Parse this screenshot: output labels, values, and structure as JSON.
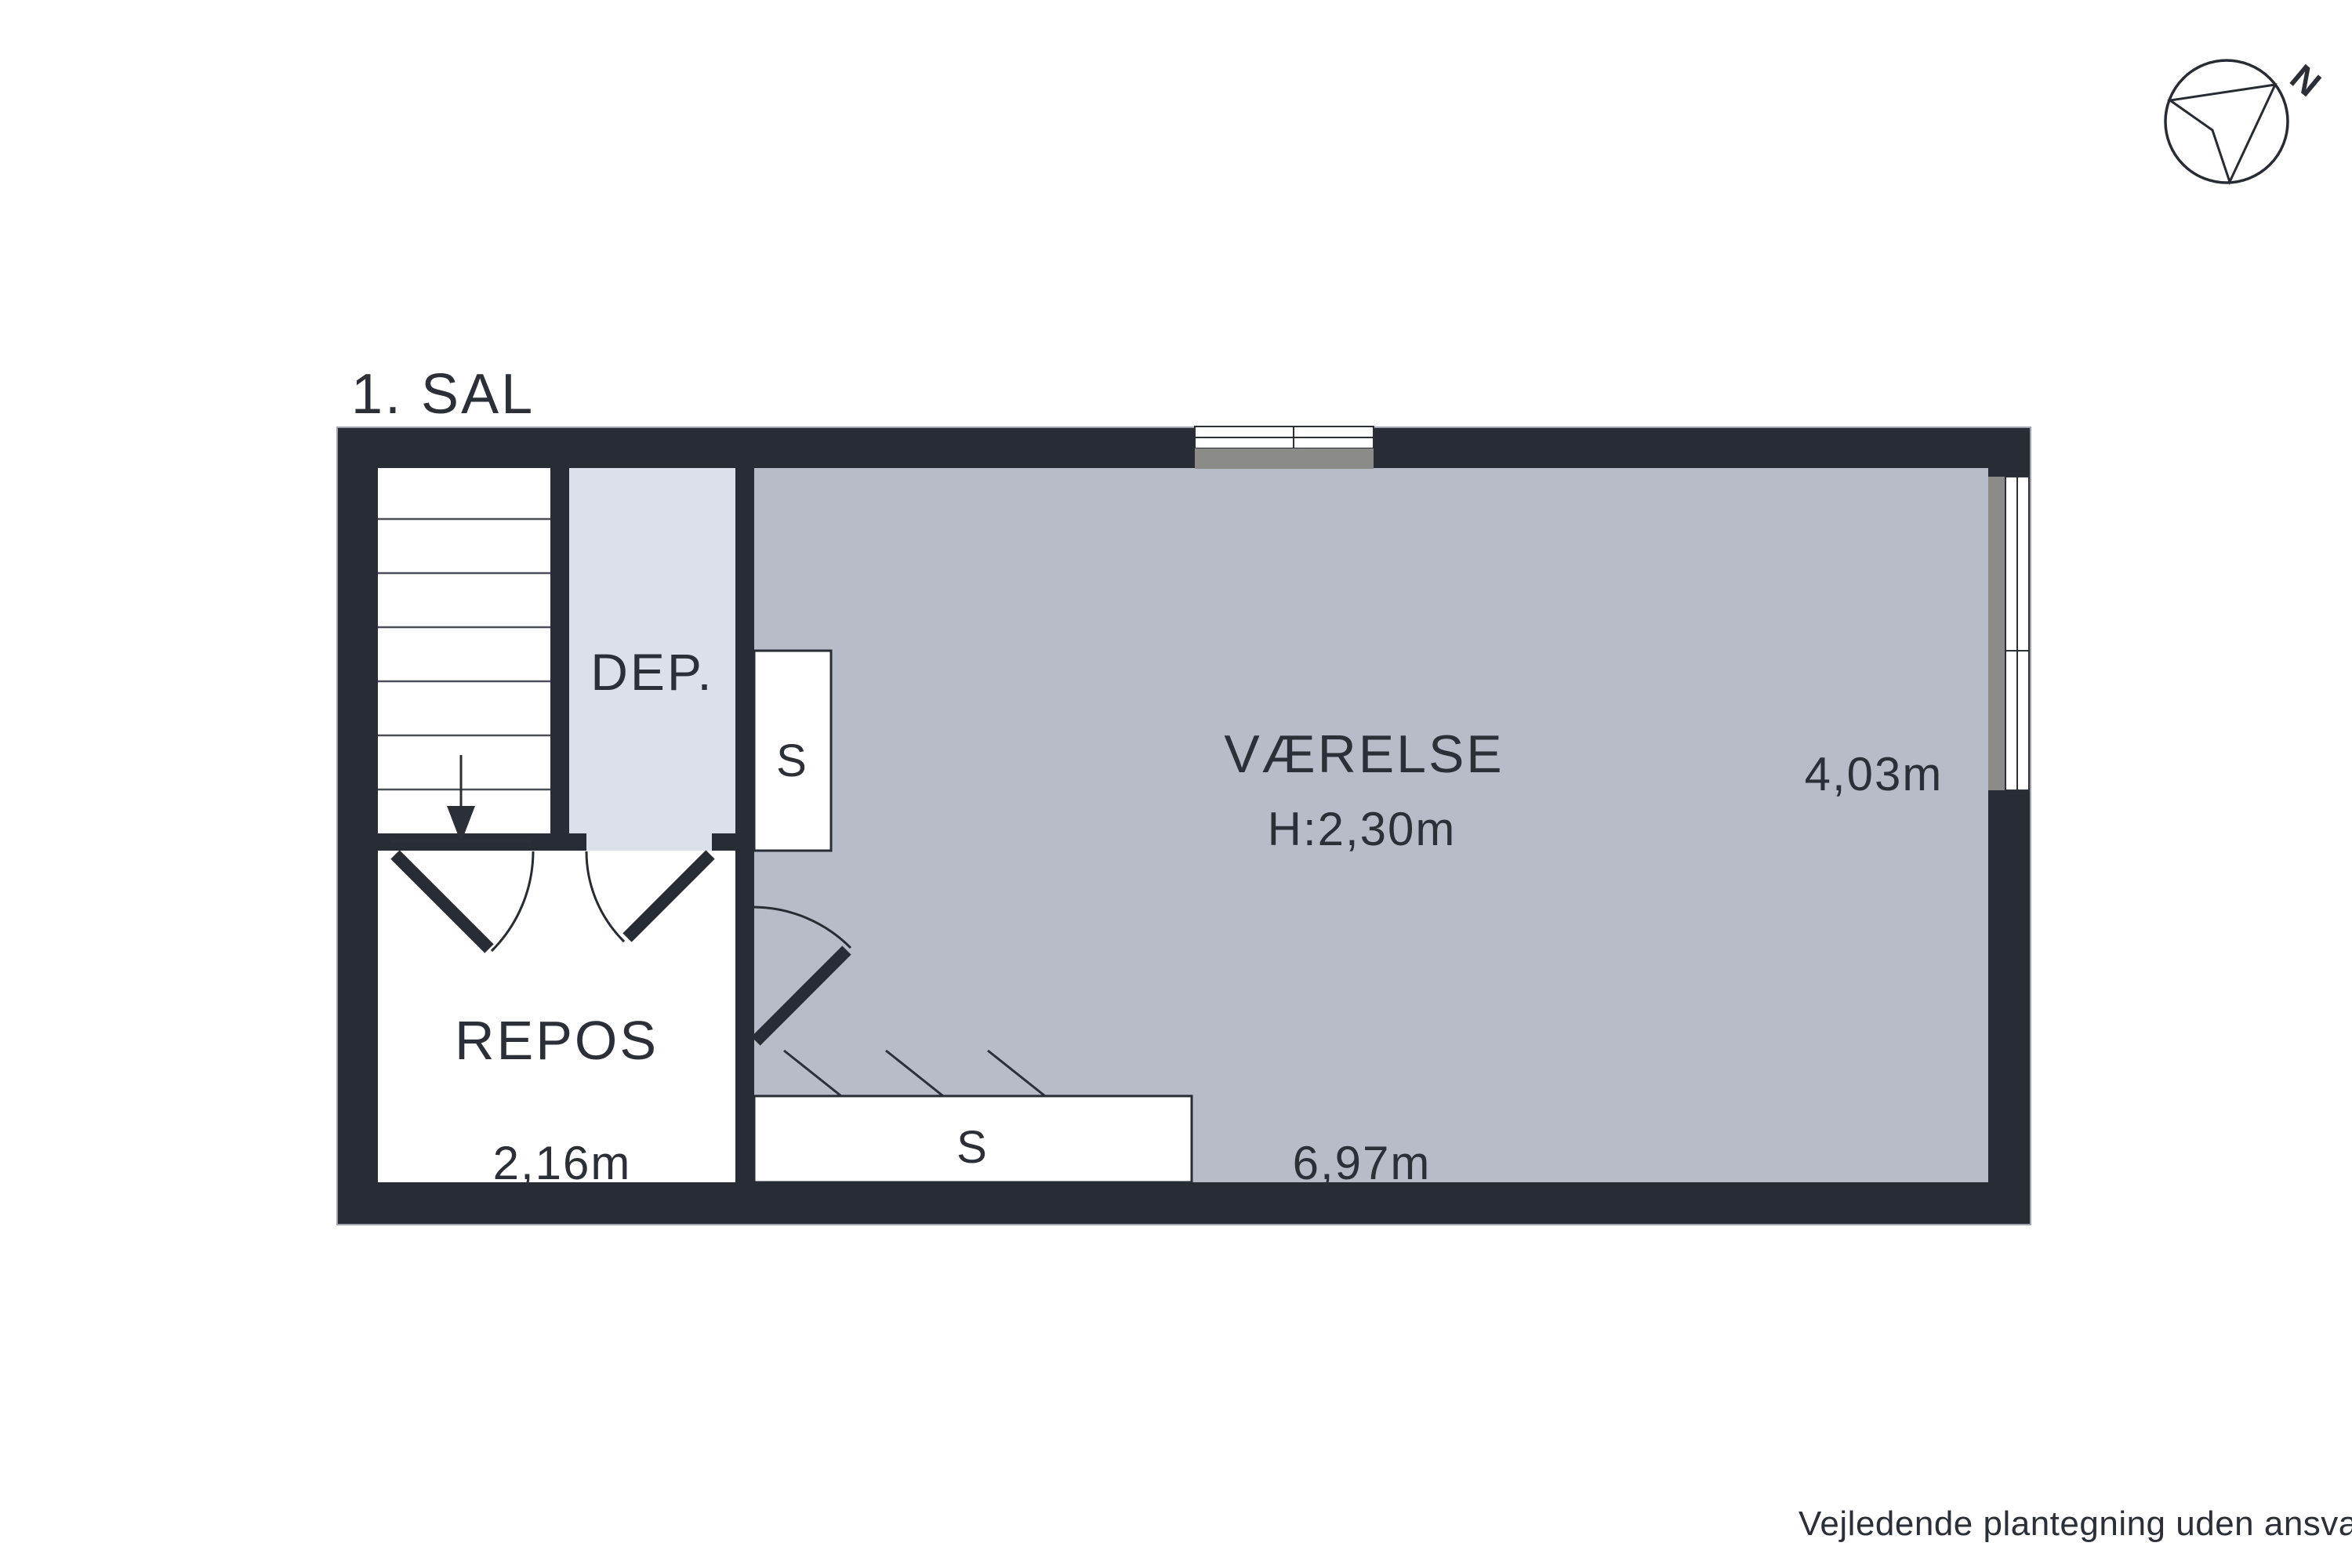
{
  "title": "1. SAL",
  "rooms": {
    "dep": {
      "label": "DEP."
    },
    "repos": {
      "label": "REPOS",
      "width_m": "2,16m"
    },
    "vaerelse": {
      "label": "VÆRELSE",
      "ceiling_height": "H:2,30m",
      "depth_m": "4,03m",
      "width_m": "6,97m"
    },
    "closet_upper": {
      "label": "S"
    },
    "closet_lower": {
      "label": "S"
    }
  },
  "compass": {
    "north_label": "N"
  },
  "footer": {
    "disclaimer": "Vejledende plantegning uden ansvar"
  },
  "colors": {
    "wall": "#282c35",
    "vaerelse_fill": "#b7bcc8",
    "dep_fill": "#dbe0eb",
    "window_sill": "#8b8b88",
    "floor_white": "#ffffff",
    "text": "#2b2f38"
  }
}
